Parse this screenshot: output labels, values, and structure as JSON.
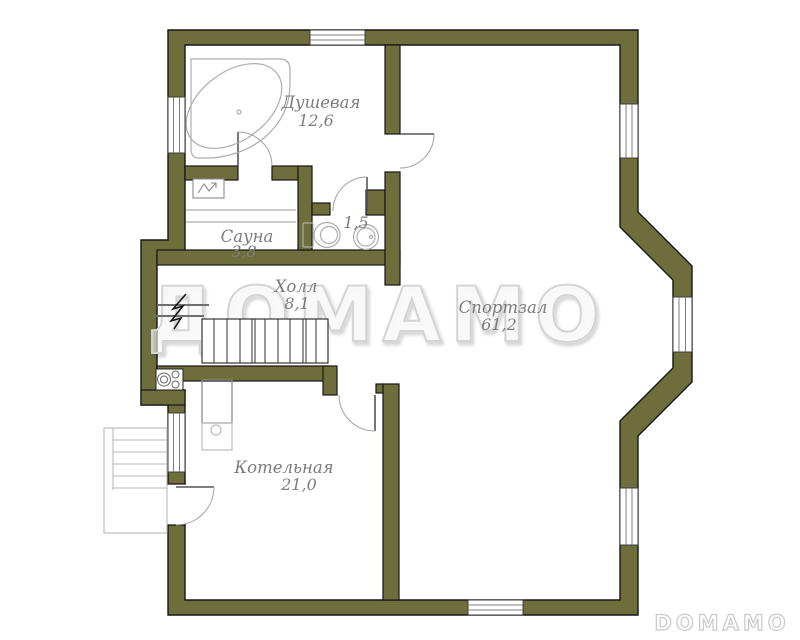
{
  "watermark": {
    "center_text": "ДОМАМО",
    "corner_text": "DOMAMO"
  },
  "rooms": [
    {
      "id": "shower",
      "name": "Душевая",
      "area": "12,6"
    },
    {
      "id": "sauna",
      "name": "Сауна",
      "area": "3,8"
    },
    {
      "id": "wc",
      "name": "",
      "area": "1,5"
    },
    {
      "id": "hall",
      "name": "Холл",
      "area": "8,1"
    },
    {
      "id": "gym",
      "name": "Спортзал",
      "area": "61,2"
    },
    {
      "id": "boiler",
      "name": "Котельная",
      "area": "21,0"
    }
  ],
  "symbols": [
    "corner-bathtub",
    "sauna-heater",
    "toilet",
    "corner-sink",
    "staircase",
    "stair-break-line",
    "stove",
    "boiler-unit",
    "entry-porch-steps",
    "window",
    "door-swing"
  ],
  "colors": {
    "wall": "#6e6e3c",
    "outline": "#161616",
    "fixture": "#adadad",
    "glyph": "#8a8a8a",
    "label": "#7c7c7c",
    "watermark": "#d4d4d4",
    "logo": "#c9c9c9",
    "window_line": "#7c7c7c",
    "door_leaf": "#555555",
    "door_arc": "#9f9f9f"
  }
}
